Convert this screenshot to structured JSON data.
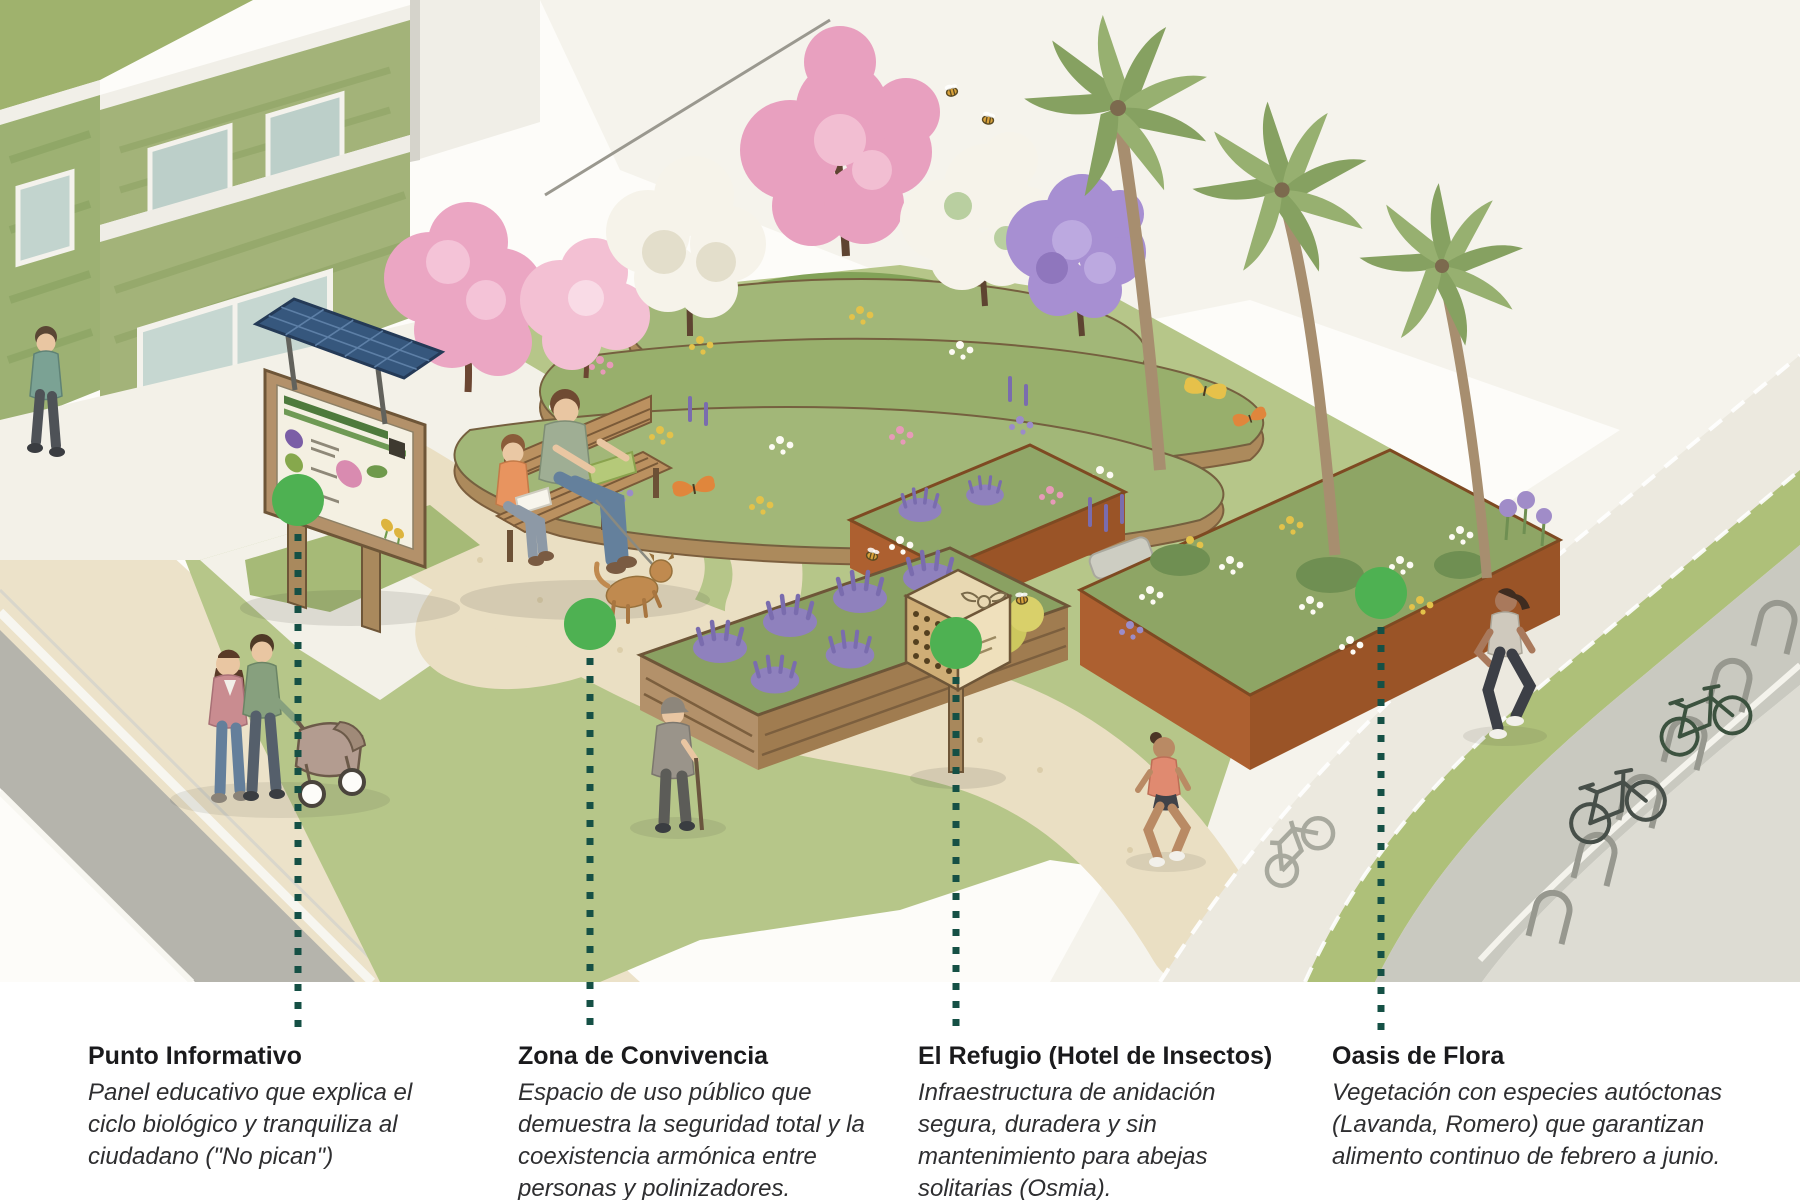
{
  "colors": {
    "marker_green": "#4EB152",
    "leader_line": "#155045",
    "title_text": "#1A1A1C",
    "body_text": "#2E2E30",
    "background": "#FFFFFF",
    "grass": "#B6C689",
    "gravel_path": "#EADFC3",
    "pavement": "#F3F1E8",
    "road_grey": "#B5B4AC",
    "corten_planter": "#A0572A",
    "wood": "#B3916A",
    "lavender": "#8F81BD",
    "blossom_pink": "#E8A0BF",
    "blossom_white": "#F6F3EA",
    "jacaranda_purple": "#A78FD2",
    "palm_green": "#86A161",
    "living_wall_green": "#A3B379",
    "solar_blue": "#36577D"
  },
  "callouts": [
    {
      "id": "punto-informativo",
      "title": "Punto Informativo",
      "description": "Panel educativo que explica el ciclo biológico y tranquiliza al ciudadano (\"No pican\")"
    },
    {
      "id": "zona-de-convivencia",
      "title": "Zona de Convivencia",
      "description": "Espacio de uso público que demuestra la seguridad total y la coexistencia armónica entre personas y polinizadores."
    },
    {
      "id": "el-refugio",
      "title": "El Refugio (Hotel de Insectos)",
      "description": "Infraestructura de anidación segura, duradera y sin mantenimiento para abejas solitarias (Osmia)."
    },
    {
      "id": "oasis-de-flora",
      "title": "Oasis de Flora",
      "description": "Vegetación con especies autóctonas (Lavanda, Romero) que garantizan alimento continuo de febrero a junio."
    }
  ],
  "icons": {
    "marker-dot": "filled green circle",
    "leader-line": "vertical dotted line",
    "info-panel-icon": "signboard on wooden posts",
    "solar-panel-icon": "tilted blue grid panel",
    "bench-icon": "wooden park bench",
    "insect-hotel-icon": "wooden box with nesting holes on a post",
    "palm-tree-icon": "palm trunk with fan of fronds",
    "blossom-tree-icon": "flowering tree canopy",
    "bicycle-icon": "two-wheel bicycle outline",
    "bike-rack-icon": "inverted-U hoops",
    "bike-lane-icon": "painted bicycle lane symbol",
    "bee-icon": "striped bee with wings",
    "butterfly-icon": "two-winged butterfly",
    "stroller-icon": "baby stroller",
    "dog-icon": "small dog on leash"
  }
}
